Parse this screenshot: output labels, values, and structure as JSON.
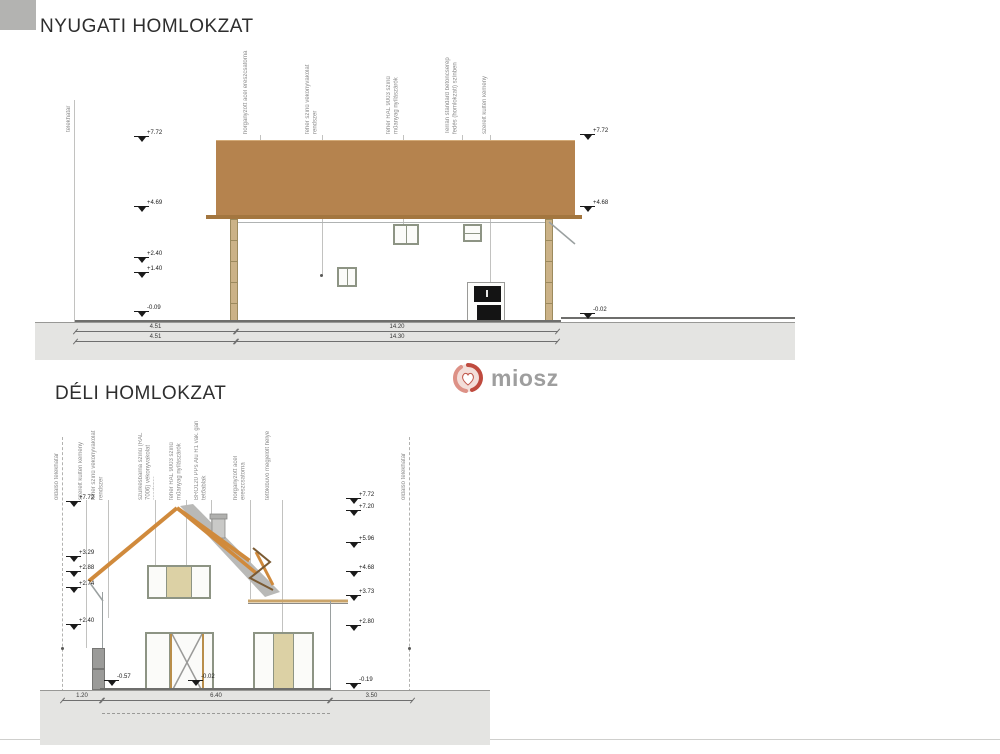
{
  "meta": {
    "drawing_type": "architectural elevations",
    "colors": {
      "roof_brown": "#b5834e",
      "eave_orange": "#d08a3c",
      "ground_gray": "#e4e4e2",
      "frame_green": "#8d9484",
      "panel_beige": "#dcd1a5",
      "logo_red": "#bf4a3e"
    }
  },
  "logo": {
    "text": "miosz"
  },
  "west": {
    "title": "NYUGATI HOMLOKZAT",
    "labels": [
      "telekhatár",
      "horganyzott acél ereszcsatorna",
      "fehér színű vékonyvakolat rendszer",
      "fehér RAL 9003 színű műanyag nyílászárók",
      "Terrán standard betoncserép fedés (homlokzati) színben",
      "szerelt kültéri kémény"
    ],
    "markers_left": [
      "+7.72",
      "+4.69",
      "+2.40",
      "+1.40",
      "-0.09"
    ],
    "markers_right": [
      "+7.72",
      "+4.68",
      "-0.02"
    ],
    "dims_row1": [
      "4.51",
      "14.20"
    ],
    "dims_row2": [
      "4.51",
      "14.30"
    ]
  },
  "south": {
    "title": "DÉLI HOMLOKZAT",
    "labels": [
      "oldalsó telekhatár",
      "szerelt kültéri kémény",
      "fehér színű vékonyvakolat rendszer",
      "szürkésbarna színű (RAL 7006) vékonyvakolat rendszer",
      "fehér RAL 9003 színű műanyag nyílászárók",
      "BRO120 PPs Alu R1 vak. gari tetőablak",
      "horganyzott acél ereszcsatorna",
      "tetőkibúvó megjelölt helye",
      "oldalsó telekhatár"
    ],
    "markers_left": [
      "+7.72",
      "+3.29",
      "+2.88",
      "+2.74",
      "+2.40"
    ],
    "markers_right": [
      "+7.72",
      "+7.20",
      "+5.96",
      "+4.68",
      "+3.73",
      "+2.80",
      "-0.19"
    ],
    "marker_ground_left": "-0.57",
    "marker_door": "-0.02",
    "dims": [
      "1.20",
      "6.40",
      "3.50"
    ]
  }
}
